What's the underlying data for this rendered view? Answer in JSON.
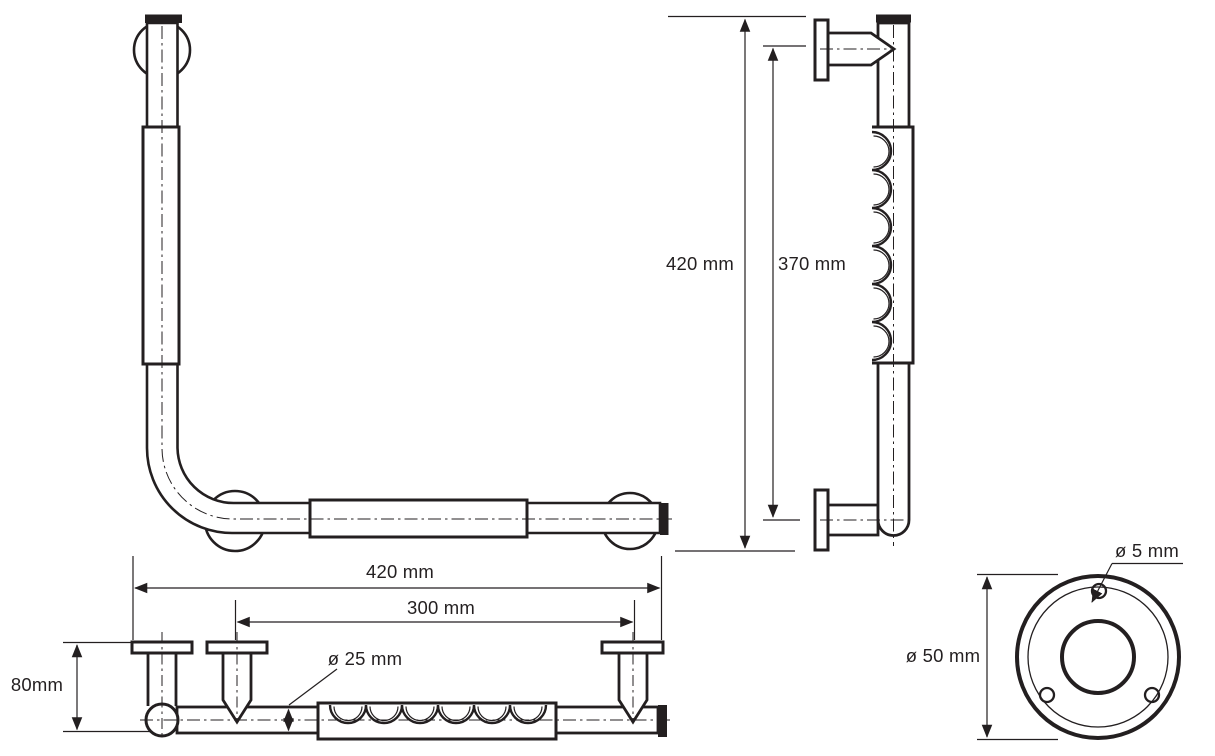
{
  "drawing": {
    "type": "technical-drawing-grab-bar",
    "colors": {
      "line": "#231f20",
      "background": "#ffffff"
    },
    "labels": {
      "side_total_height": "420 mm",
      "side_grip_length": "370 mm",
      "bottom_total_width": "420 mm",
      "bottom_mount_spacing": "300 mm",
      "tube_diameter": "ø 25 mm",
      "mount_projection": "80mm",
      "flange_outer_diameter": "ø 50 mm",
      "flange_screw_hole_diameter": "ø 5 mm"
    }
  }
}
